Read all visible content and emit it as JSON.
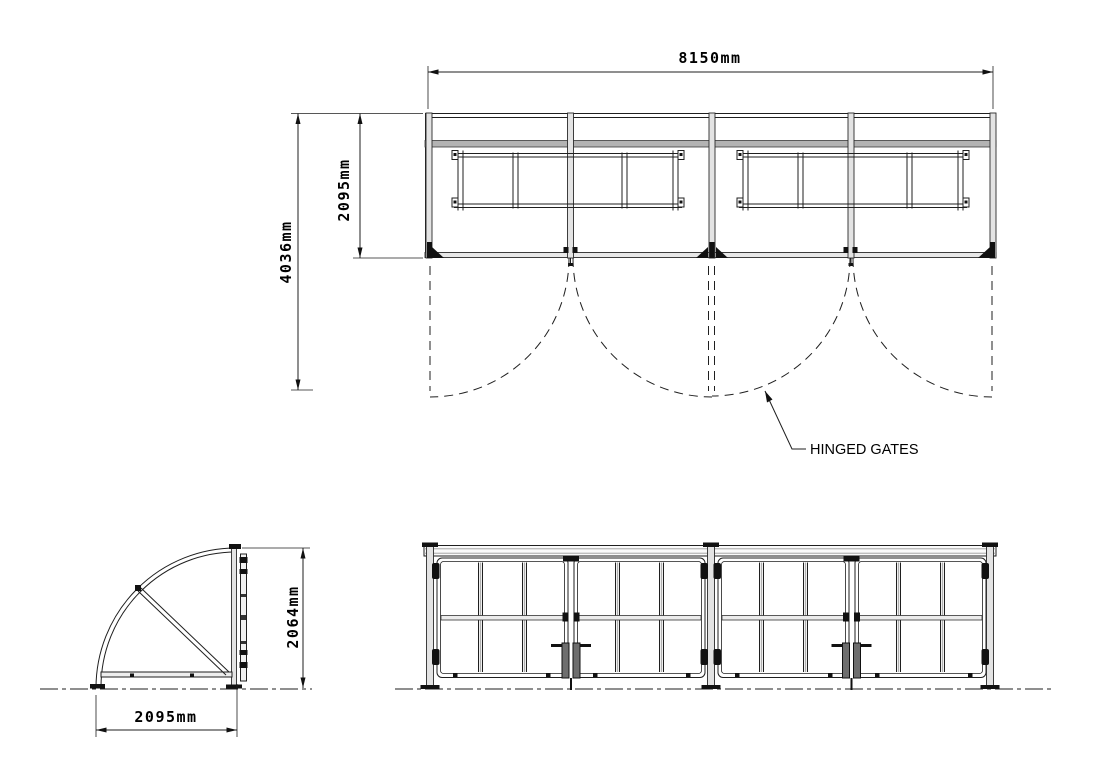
{
  "drawing": {
    "labels": {
      "hinged_gates": "HINGED GATES"
    },
    "dimensions": {
      "plan_width": "8150mm",
      "plan_total_depth": "4036mm",
      "plan_shelter_depth": "2095mm",
      "side_height": "2064mm",
      "side_width": "2095mm"
    },
    "colors": {
      "line": "#1f1f1f",
      "gray_fill": "#b3b3b3",
      "background": "#ffffff"
    }
  }
}
